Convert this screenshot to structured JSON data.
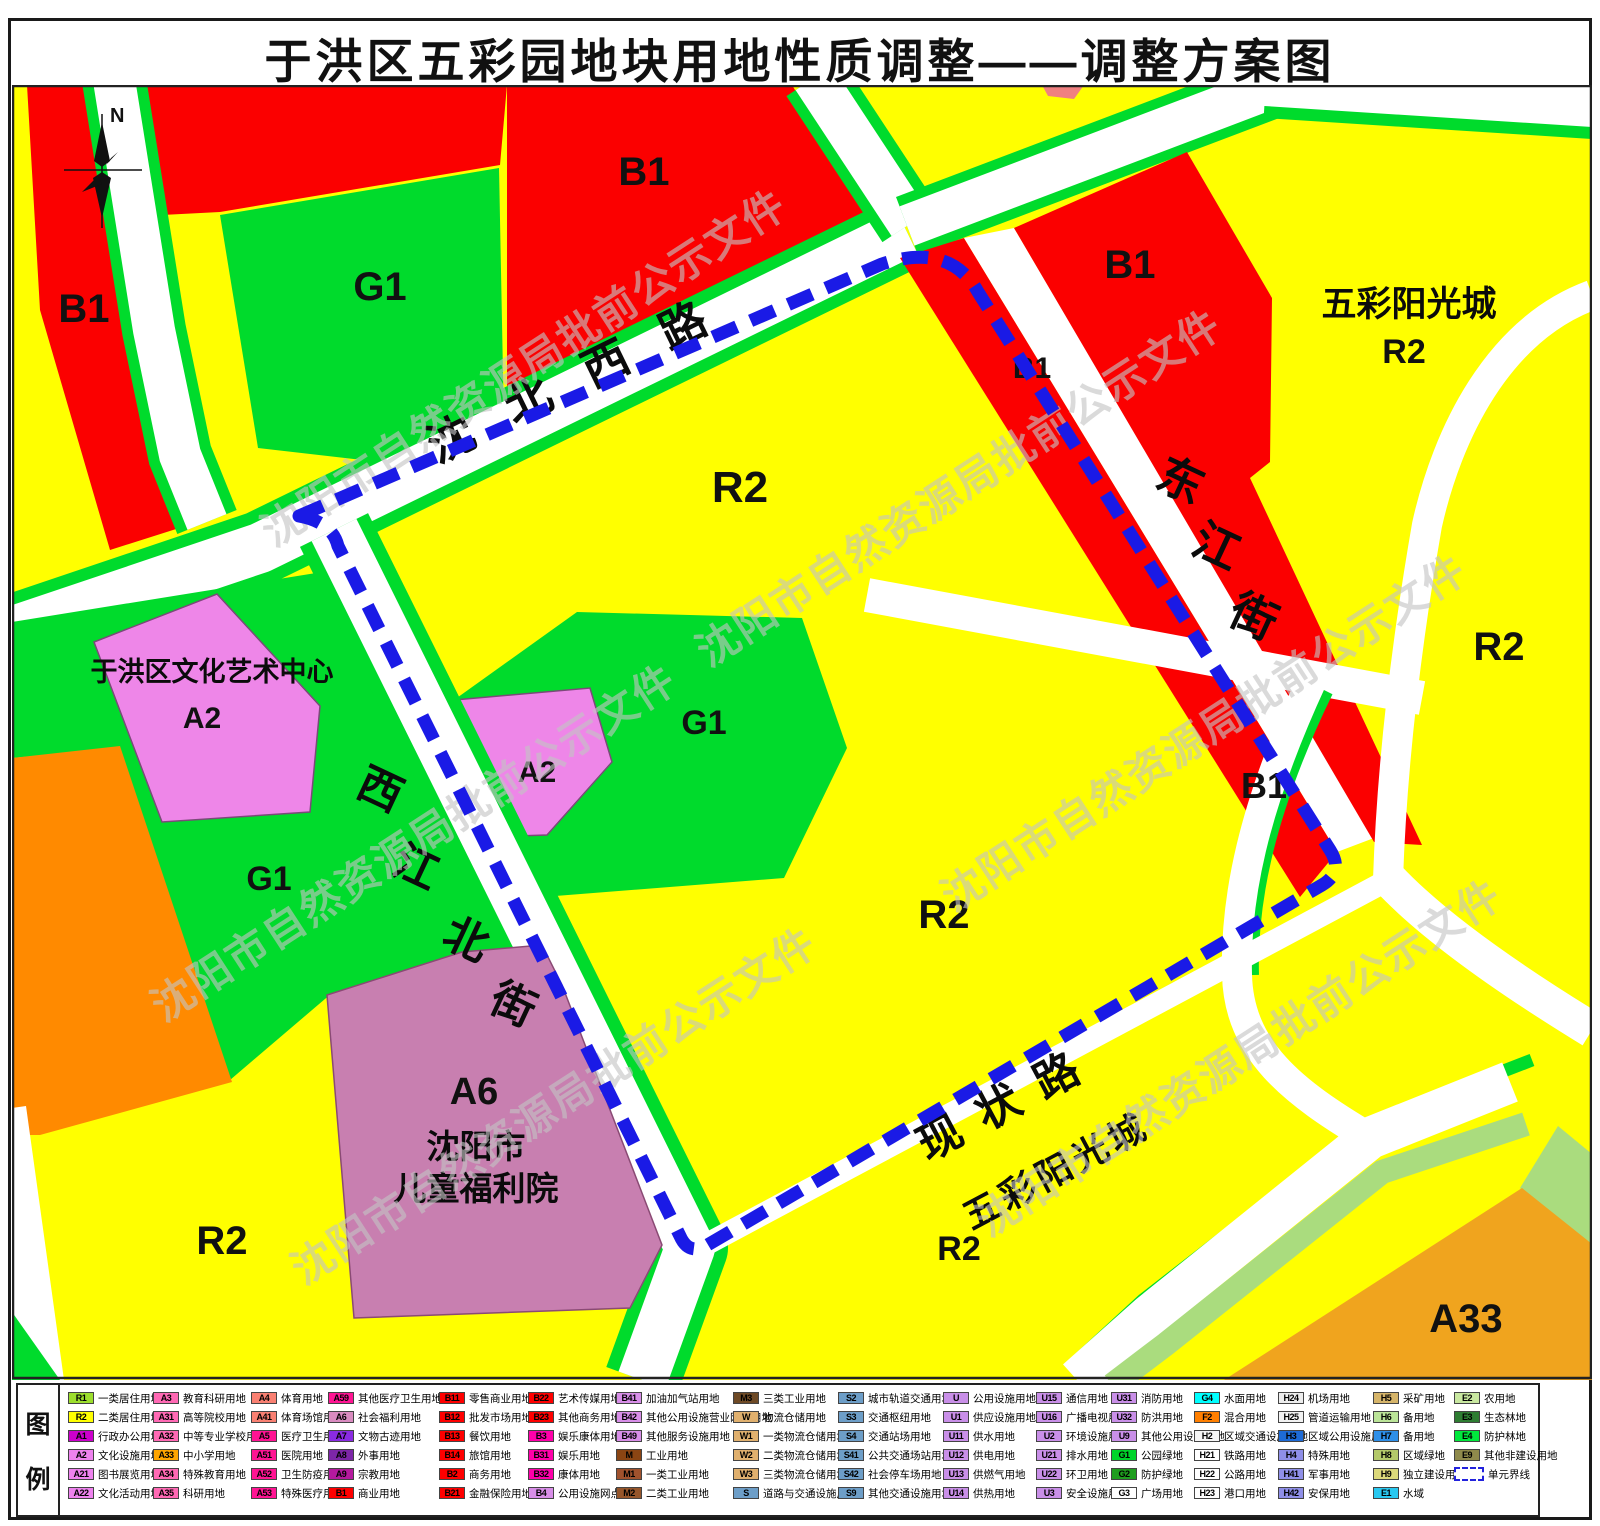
{
  "title": "于洪区五彩园地块用地性质调整——调整方案图",
  "watermark": {
    "text": "沈阳市自然资源局批前公示文件"
  },
  "compass": {
    "label": "N"
  },
  "colors": {
    "residential_r2": "#FFFF00",
    "commercial_b1": "#FB0000",
    "green_g1": "#00DB2C",
    "culture_a2": "#EE86E8",
    "welfare_a6": "#C87FB0",
    "orange_f2": "#FF8A00",
    "school_a33": "#F0A41E",
    "pale_green": "#AADC7E",
    "boundary_blue": "#1A1AE6"
  },
  "map": {
    "roads": {
      "shenbei_west_road": "沈北西路",
      "dongjiang_street": [
        "东",
        "江",
        "街"
      ],
      "xijiangbei_street": [
        "西",
        "江",
        "北",
        "街"
      ],
      "xianzhuang_road": "现状路"
    },
    "landmarks": {
      "culture_center": "于洪区文化艺术中心",
      "culture_center_code": "A2",
      "children_welfare_line1": "沈阳市",
      "children_welfare_line2": "儿童福利院",
      "children_welfare_code": "A6",
      "sunshine_city_ne": "五彩阳光城",
      "sunshine_city_ne_code": "R2",
      "sunshine_city_s": "五彩阳光城"
    },
    "zone_labels": {
      "b1_topleft": "B1",
      "g1_topleft": "G1",
      "b1_topcenter": "B1",
      "r2_center": "R2",
      "b1_ne": "B1",
      "b1_dongjiang_n": "B1",
      "b1_dongjiang_s": "B1",
      "r2_east": "R2",
      "g1_center": "G1",
      "a2_center": "A2",
      "g1_west": "G1",
      "r2_center_south": "R2",
      "r2_south_inner": "R2",
      "r2_southwest": "R2",
      "a33_southeast": "A33"
    }
  },
  "legend": {
    "panel_label_top": "图",
    "panel_label_bottom": "例",
    "columns": [
      [
        {
          "c": "R1",
          "l": "一类居住用地",
          "bg": "#9CDE2D"
        },
        {
          "c": "R2",
          "l": "二类居住用地",
          "bg": "#FFFF00"
        },
        {
          "c": "A1",
          "l": "行政办公用地",
          "bg": "#CC00CC"
        },
        {
          "c": "A2",
          "l": "文化设施用地",
          "bg": "#EE82EE"
        },
        {
          "c": "A21",
          "l": "图书展览用地",
          "bg": "#EE82EE"
        },
        {
          "c": "A22",
          "l": "文化活动用地",
          "bg": "#EE82EE"
        }
      ],
      [
        {
          "c": "A3",
          "l": "教育科研用地",
          "bg": "#FF69B4"
        },
        {
          "c": "A31",
          "l": "高等院校用地",
          "bg": "#FF69B4"
        },
        {
          "c": "A32",
          "l": "中等专业学校用地",
          "bg": "#FF69B4"
        },
        {
          "c": "A33",
          "l": "中小学用地",
          "bg": "#FFA500"
        },
        {
          "c": "A34",
          "l": "特殊教育用地",
          "bg": "#FF69B4"
        },
        {
          "c": "A35",
          "l": "科研用地",
          "bg": "#FF69B4"
        }
      ],
      [
        {
          "c": "A4",
          "l": "体育用地",
          "bg": "#F98072"
        },
        {
          "c": "A41",
          "l": "体育场馆用地",
          "bg": "#F98072"
        },
        {
          "c": "A5",
          "l": "医疗卫生用地",
          "bg": "#FF1493"
        },
        {
          "c": "A51",
          "l": "医院用地",
          "bg": "#FF1493"
        },
        {
          "c": "A52",
          "l": "卫生防疫用地",
          "bg": "#FF1493"
        },
        {
          "c": "A53",
          "l": "特殊医疗用地",
          "bg": "#FF1493"
        }
      ],
      [
        {
          "c": "A59",
          "l": "其他医疗卫生用地",
          "bg": "#FF1493"
        },
        {
          "c": "A6",
          "l": "社会福利用地",
          "bg": "#D98BC0"
        },
        {
          "c": "A7",
          "l": "文物古迹用地",
          "bg": "#8A2BE2"
        },
        {
          "c": "A8",
          "l": "外事用地",
          "bg": "#7D26A8"
        },
        {
          "c": "A9",
          "l": "宗教用地",
          "bg": "#B5199E"
        },
        {
          "c": "B1",
          "l": "商业用地",
          "bg": "#FF0000"
        }
      ],
      [
        {
          "c": "B11",
          "l": "零售商业用地",
          "bg": "#FF0000"
        },
        {
          "c": "B12",
          "l": "批发市场用地",
          "bg": "#FF0000"
        },
        {
          "c": "B13",
          "l": "餐饮用地",
          "bg": "#FF0000"
        },
        {
          "c": "B14",
          "l": "旅馆用地",
          "bg": "#FF0000"
        },
        {
          "c": "B2",
          "l": "商务用地",
          "bg": "#FF0000"
        },
        {
          "c": "B21",
          "l": "金融保险用地",
          "bg": "#FF0000"
        }
      ],
      [
        {
          "c": "B22",
          "l": "艺术传媒用地",
          "bg": "#FF0000"
        },
        {
          "c": "B23",
          "l": "其他商务用地",
          "bg": "#FF0000"
        },
        {
          "c": "B3",
          "l": "娱乐康体用地",
          "bg": "#FF00AA"
        },
        {
          "c": "B31",
          "l": "娱乐用地",
          "bg": "#FF00AA"
        },
        {
          "c": "B32",
          "l": "康体用地",
          "bg": "#FF00AA"
        },
        {
          "c": "B4",
          "l": "公用设施网点用地",
          "bg": "#D88EE8"
        }
      ],
      [
        {
          "c": "B41",
          "l": "加油加气站用地",
          "bg": "#D88EE8"
        },
        {
          "c": "B42",
          "l": "其他公用设施营业网点用地",
          "bg": "#D88EE8"
        },
        {
          "c": "B49",
          "l": "其他服务设施用地",
          "bg": "#D88EE8"
        },
        {
          "c": "M",
          "l": "工业用地",
          "bg": "#8B4513"
        },
        {
          "c": "M1",
          "l": "一类工业用地",
          "bg": "#A0522D"
        },
        {
          "c": "M2",
          "l": "二类工业用地",
          "bg": "#96562B"
        }
      ],
      [
        {
          "c": "M3",
          "l": "三类工业用地",
          "bg": "#6E4A26"
        },
        {
          "c": "W",
          "l": "物流仓储用地",
          "bg": "#E0B06E"
        },
        {
          "c": "W1",
          "l": "一类物流仓储用地",
          "bg": "#E0B06E"
        },
        {
          "c": "W2",
          "l": "二类物流仓储用地",
          "bg": "#E0B06E"
        },
        {
          "c": "W3",
          "l": "三类物流仓储用地",
          "bg": "#E0B06E"
        },
        {
          "c": "S",
          "l": "道路与交通设施用地",
          "bg": "#6D9EC8"
        }
      ],
      [
        {
          "c": "S2",
          "l": "城市轨道交通用地",
          "bg": "#6D9EC8"
        },
        {
          "c": "S3",
          "l": "交通枢纽用地",
          "bg": "#6D9EC8"
        },
        {
          "c": "S4",
          "l": "交通站场用地",
          "bg": "#6D9EC8"
        },
        {
          "c": "S41",
          "l": "公共交通场站用地",
          "bg": "#6D9EC8"
        },
        {
          "c": "S42",
          "l": "社会停车场用地",
          "bg": "#6D9EC8"
        },
        {
          "c": "S9",
          "l": "其他交通设施用地",
          "bg": "#6D9EC8"
        }
      ],
      [
        {
          "c": "U",
          "l": "公用设施用地",
          "bg": "#C98FE8"
        },
        {
          "c": "U1",
          "l": "供应设施用地",
          "bg": "#C98FE8"
        },
        {
          "c": "U11",
          "l": "供水用地",
          "bg": "#C98FE8"
        },
        {
          "c": "U12",
          "l": "供电用地",
          "bg": "#C98FE8"
        },
        {
          "c": "U13",
          "l": "供燃气用地",
          "bg": "#C98FE8"
        },
        {
          "c": "U14",
          "l": "供热用地",
          "bg": "#C98FE8"
        }
      ],
      [
        {
          "c": "U15",
          "l": "通信用地",
          "bg": "#C98FE8"
        },
        {
          "c": "U16",
          "l": "广播电视用地",
          "bg": "#C98FE8"
        },
        {
          "c": "U2",
          "l": "环境设施用地",
          "bg": "#C98FE8"
        },
        {
          "c": "U21",
          "l": "排水用地",
          "bg": "#C98FE8"
        },
        {
          "c": "U22",
          "l": "环卫用地",
          "bg": "#C98FE8"
        },
        {
          "c": "U3",
          "l": "安全设施用地",
          "bg": "#C98FE8"
        }
      ],
      [
        {
          "c": "U31",
          "l": "消防用地",
          "bg": "#C98FE8"
        },
        {
          "c": "U32",
          "l": "防洪用地",
          "bg": "#C98FE8"
        },
        {
          "c": "U9",
          "l": "其他公用设施用地",
          "bg": "#C98FE8"
        },
        {
          "c": "G1",
          "l": "公园绿地",
          "bg": "#00D42A"
        },
        {
          "c": "G2",
          "l": "防护绿地",
          "bg": "#1F9E1F"
        },
        {
          "c": "G3",
          "l": "广场用地",
          "bg": "#FFFFFF"
        }
      ],
      [
        {
          "c": "G4",
          "l": "水面用地",
          "bg": "#00FFFF"
        },
        {
          "c": "F2",
          "l": "混合用地",
          "bg": "#FF7F00"
        },
        {
          "c": "H2",
          "l": "区域交通设施用地",
          "bg": "#F5F5F5"
        },
        {
          "c": "H21",
          "l": "铁路用地",
          "bg": "#FFFFFF"
        },
        {
          "c": "H22",
          "l": "公路用地",
          "bg": "#FFFFFF"
        },
        {
          "c": "H23",
          "l": "港口用地",
          "bg": "#FFFFFF"
        }
      ],
      [
        {
          "c": "H24",
          "l": "机场用地",
          "bg": "#EDEDED"
        },
        {
          "c": "H25",
          "l": "管道运输用地",
          "bg": "#F2F2F2"
        },
        {
          "c": "H3",
          "l": "区域公用设施用地",
          "bg": "#1E6BD6"
        },
        {
          "c": "H4",
          "l": "特殊用地",
          "bg": "#8F8FE8"
        },
        {
          "c": "H41",
          "l": "军事用地",
          "bg": "#8F8FE8"
        },
        {
          "c": "H42",
          "l": "安保用地",
          "bg": "#8F8FE8"
        }
      ],
      [
        {
          "c": "H5",
          "l": "采矿用地",
          "bg": "#D6B56A"
        },
        {
          "c": "H6",
          "l": "备用地",
          "bg": "#BBE498"
        },
        {
          "c": "H7",
          "l": "备用地",
          "bg": "#2E8FE8"
        },
        {
          "c": "H8",
          "l": "区域绿地",
          "bg": "#B4C96A"
        },
        {
          "c": "H9",
          "l": "独立建设用地",
          "bg": "#DCD97B"
        },
        {
          "c": "E1",
          "l": "水域",
          "bg": "#29C8F0"
        }
      ],
      [
        {
          "c": "E2",
          "l": "农用地",
          "bg": "#C9E8A0"
        },
        {
          "c": "E3",
          "l": "生态林地",
          "bg": "#2E7D32"
        },
        {
          "c": "E4",
          "l": "防护林地",
          "bg": "#00E83C"
        },
        {
          "c": "E9",
          "l": "其他非建设用地",
          "bg": "#8F8A4B"
        },
        {
          "c": "",
          "l": "单元界线",
          "bg": "#FFFFFF",
          "dashed": true
        }
      ]
    ]
  }
}
